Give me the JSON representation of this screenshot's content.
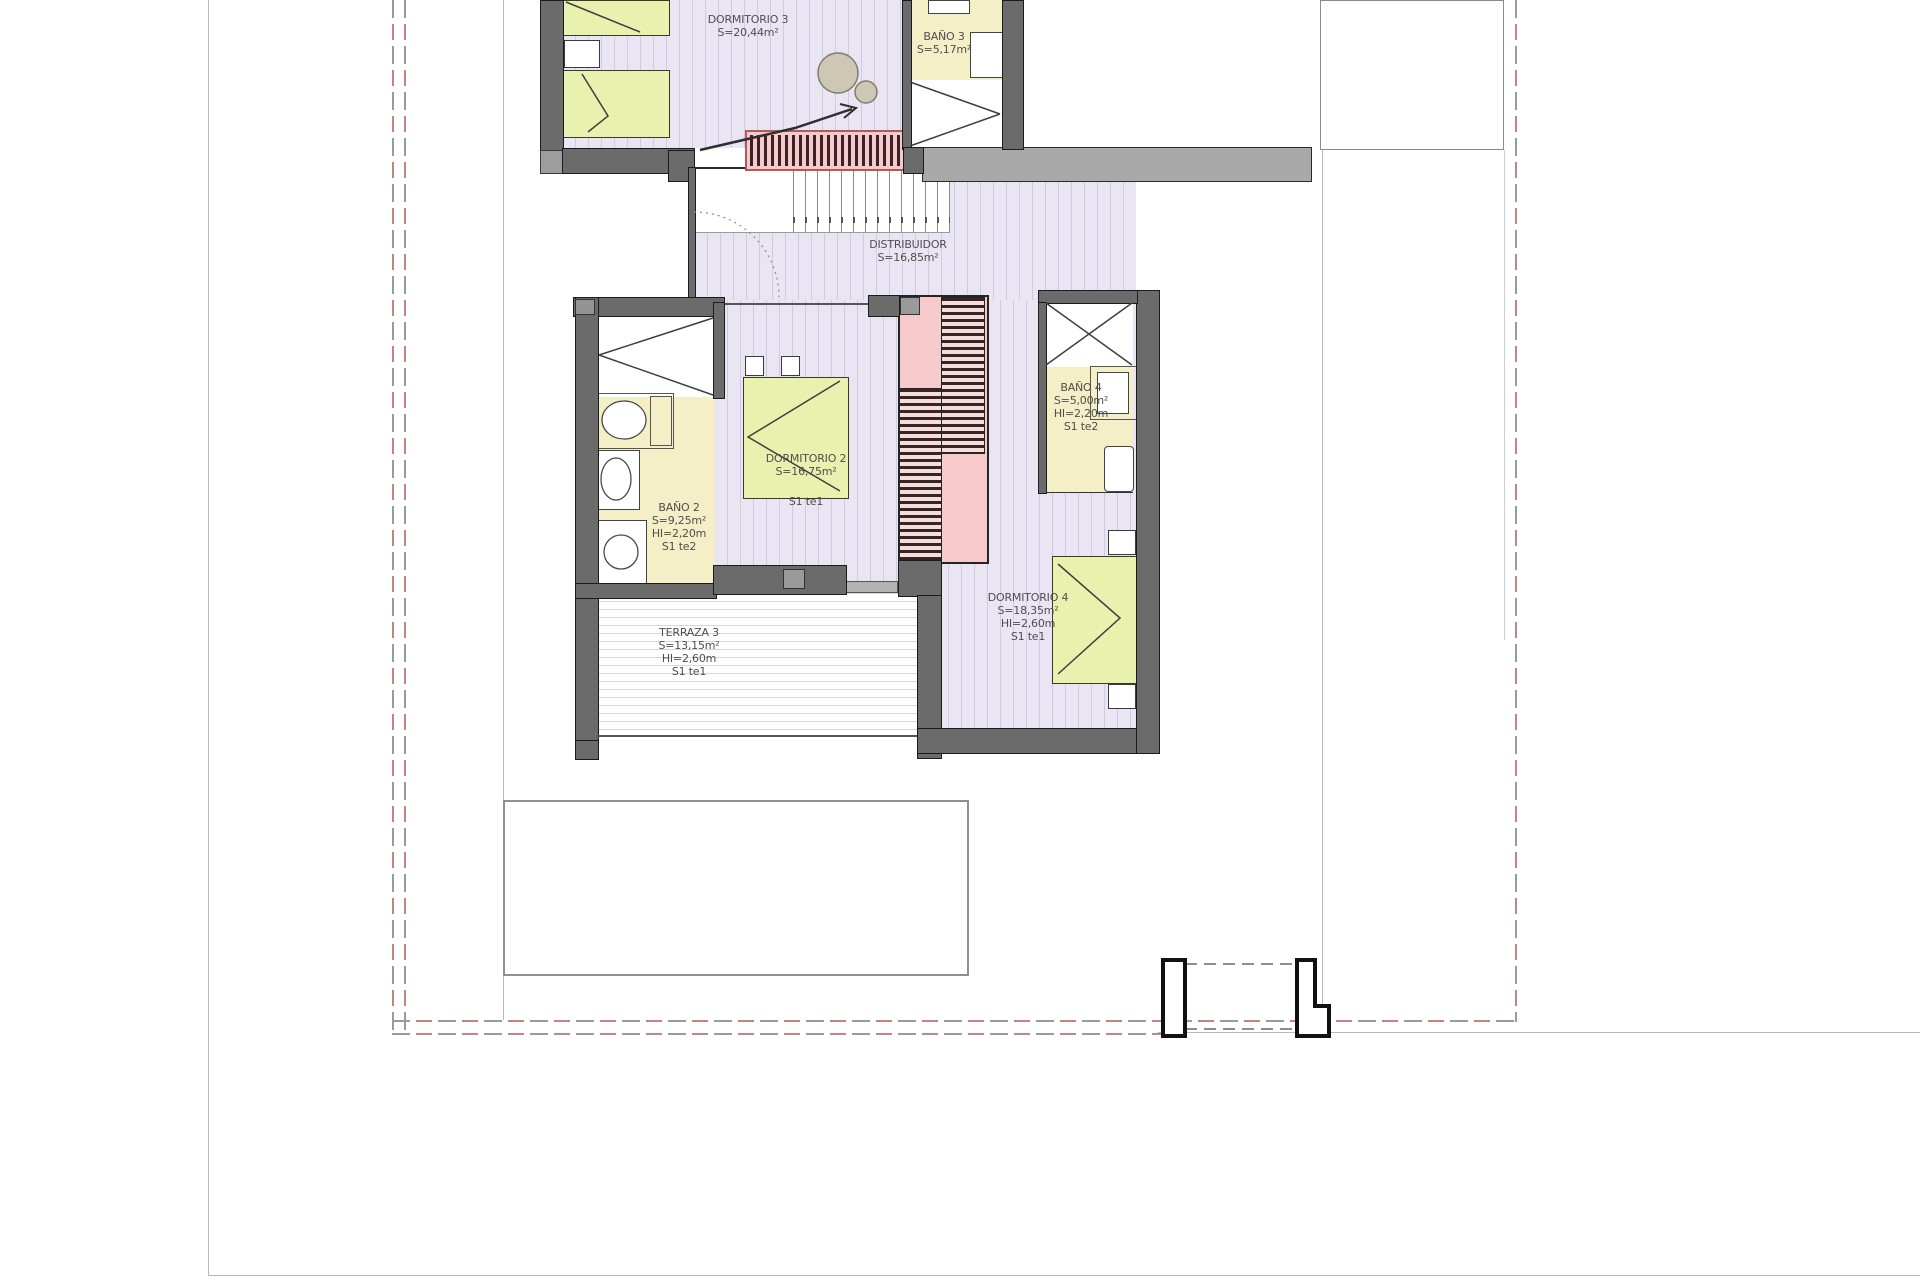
{
  "plan": {
    "type": "architectural-floor-plan-upper-level",
    "rooms": [
      {
        "id": "dormitorio-3",
        "lines": [
          "DORMITORIO 3",
          "S=20,44m²"
        ]
      },
      {
        "id": "bano-3",
        "lines": [
          "BAÑO 3",
          "S=5,17m²"
        ]
      },
      {
        "id": "distribuidor",
        "lines": [
          "DISTRIBUIDOR",
          "S=16,85m²"
        ]
      },
      {
        "id": "bano-2",
        "lines": [
          "BAÑO 2",
          "S=9,25m²",
          "HI=2,20m",
          "S1 te2"
        ]
      },
      {
        "id": "dormitorio-2",
        "lines": [
          "DORMITORIO 2",
          "S=16,75m²",
          "S1 te1"
        ]
      },
      {
        "id": "bano-4",
        "lines": [
          "BAÑO 4",
          "S=5,00m²",
          "HI=2,20m",
          "S1 te2"
        ]
      },
      {
        "id": "dormitorio-4",
        "lines": [
          "DORMITORIO 4",
          "S=18,35m²",
          "HI=2,60m",
          "S1 te1"
        ]
      },
      {
        "id": "terraza-3",
        "lines": [
          "TERRAZA 3",
          "S=13,15m²",
          "HI=2,60m",
          "S1 te1"
        ]
      }
    ],
    "colors": {
      "floor_lavender": "#eae5f2",
      "floor_bath_yellow": "#f4efc6",
      "bed_green": "#e9f1ae",
      "stair_pink": "#f6caca",
      "wall_gray": "#6b6b6b",
      "boundary_red": "#c48484"
    }
  }
}
